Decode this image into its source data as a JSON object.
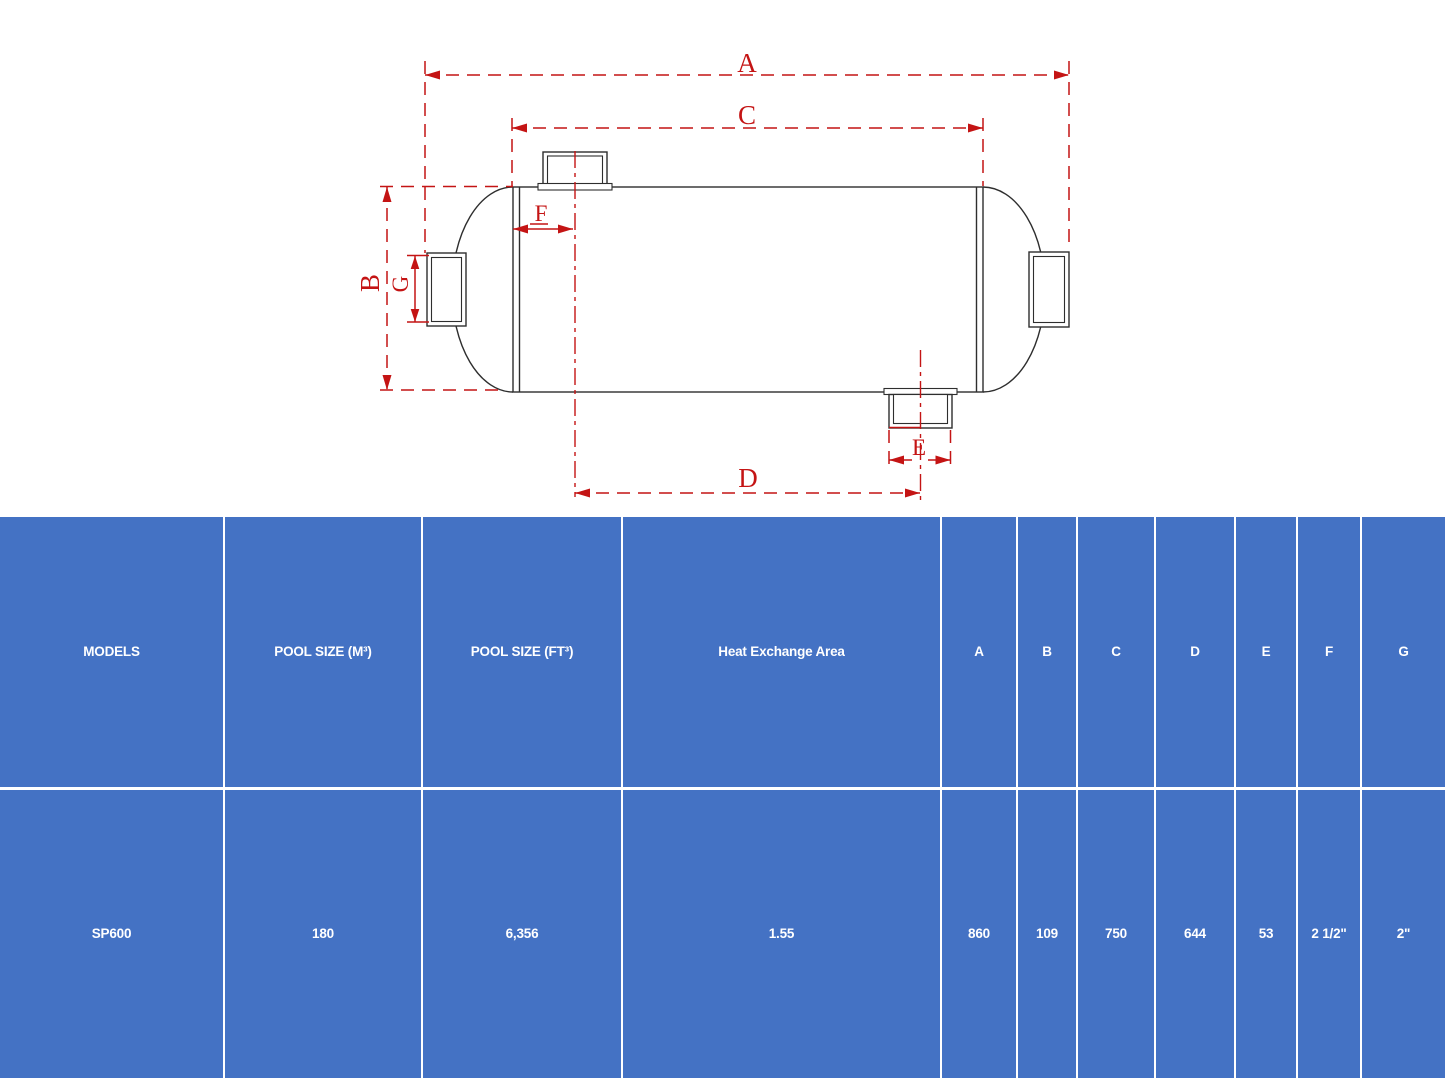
{
  "diagram": {
    "title_hint": "pool heat exchanger dimension drawing",
    "labels": {
      "a": "A",
      "b": "B",
      "c": "C",
      "d": "D",
      "e": "E",
      "f": "F",
      "g": "G"
    },
    "colors": {
      "dimension_red": "#c41414",
      "outline_black": "#2e2e2e"
    }
  },
  "table": {
    "accent_blue": "#4472c4",
    "gridline_white": "#ffffff",
    "headers": [
      "MODELS",
      "POOL SIZE (M³)",
      "POOL SIZE (FT³)",
      "Heat Exchange Area",
      "A",
      "B",
      "C",
      "D",
      "E",
      "F",
      "G"
    ],
    "rows": [
      {
        "cells": [
          "SP600",
          "180",
          "6,356",
          "1.55",
          "860",
          "109",
          "750",
          "644",
          "53",
          "2 1/2\"",
          "2\""
        ]
      }
    ]
  }
}
